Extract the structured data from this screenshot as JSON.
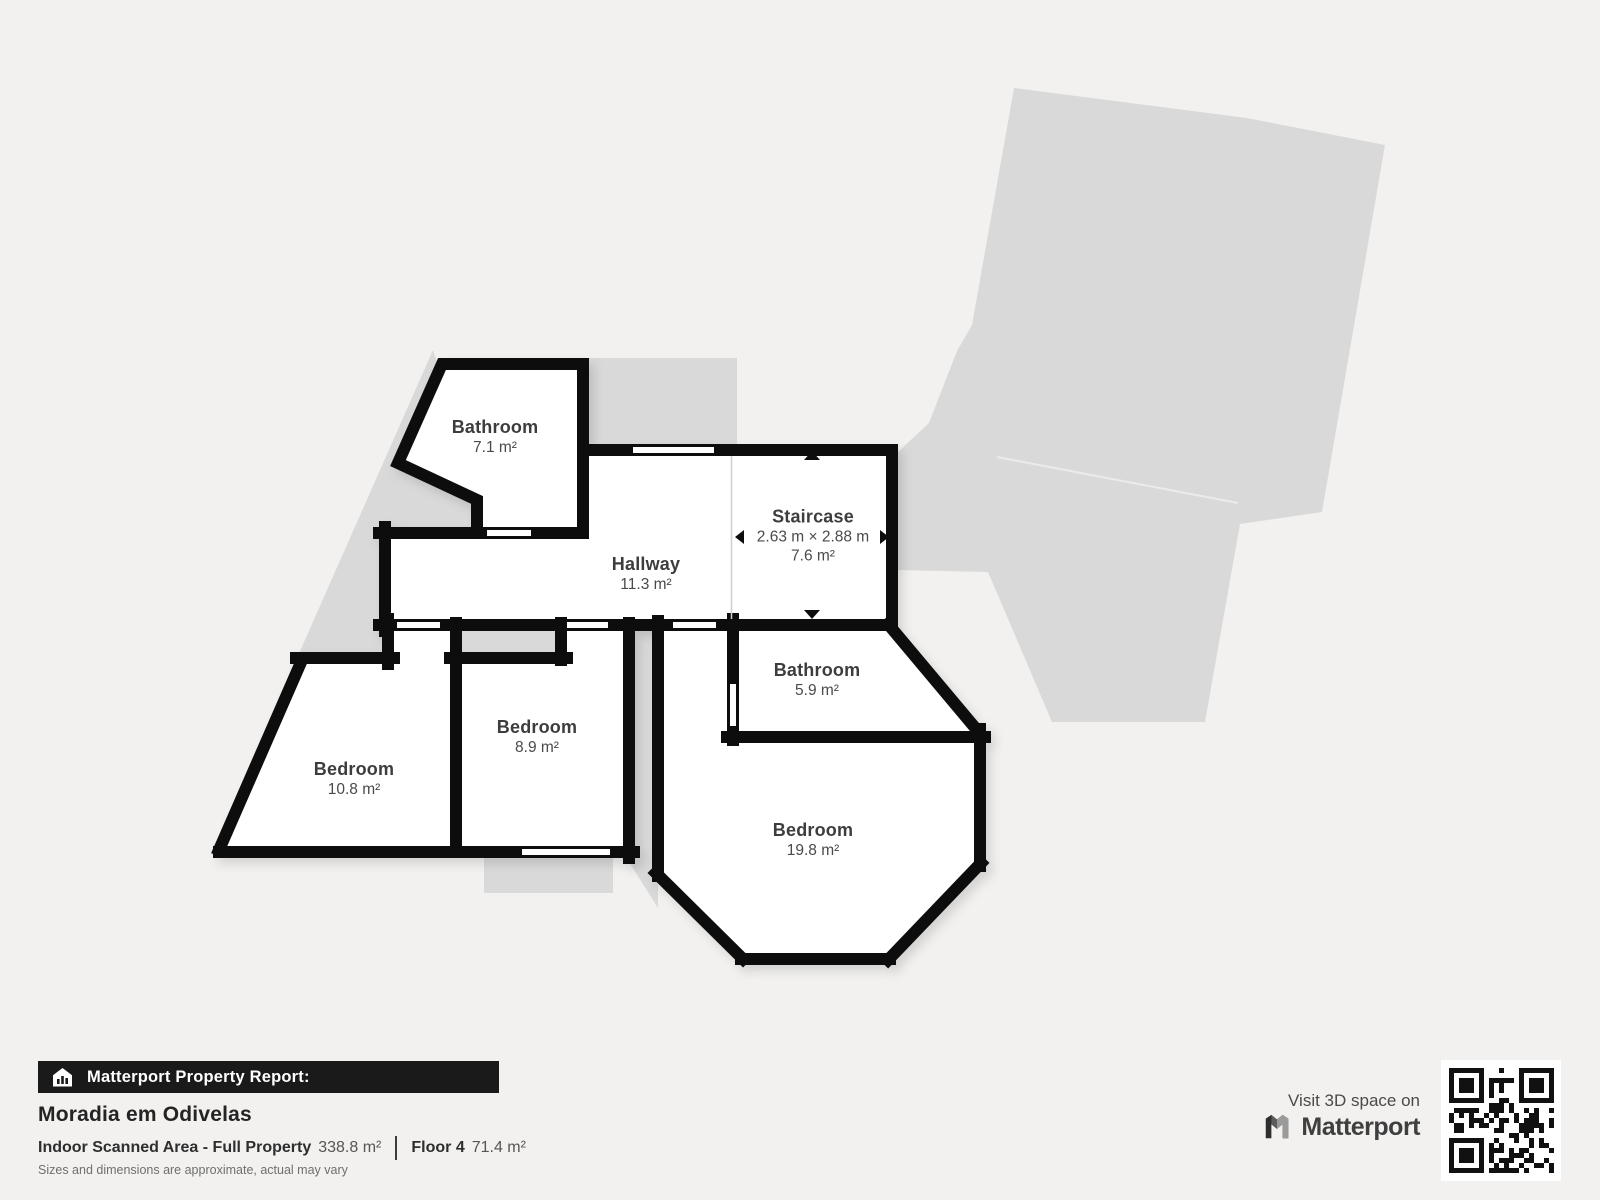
{
  "page": {
    "background": "#f2f1ef"
  },
  "floorplan": {
    "colors": {
      "wall": "#0d0d0d",
      "room_fill": "#ffffff",
      "silhouette": "#d9d9d9"
    },
    "rooms": [
      {
        "name": "Bathroom",
        "area": "7.1 m²"
      },
      {
        "name": "Hallway",
        "area": "11.3 m²"
      },
      {
        "name": "Staircase",
        "dims": "2.63 m × 2.88 m",
        "area": "7.6 m²"
      },
      {
        "name": "Bathroom",
        "area": "5.9 m²"
      },
      {
        "name": "Bedroom",
        "area": "8.9 m²"
      },
      {
        "name": "Bedroom",
        "area": "10.8 m²"
      },
      {
        "name": "Bedroom",
        "area": "19.8 m²"
      }
    ]
  },
  "report": {
    "banner": "Matterport Property Report:",
    "property_name": "Moradia em Odivelas",
    "scanned_area_label": "Indoor Scanned Area - Full Property",
    "scanned_area_value": "338.8 m²",
    "floor_label": "Floor 4",
    "floor_value": "71.4 m²",
    "disclaimer": "Sizes and dimensions are approximate, actual may vary"
  },
  "promo": {
    "visit_text": "Visit 3D space on",
    "brand": "Matterport"
  }
}
